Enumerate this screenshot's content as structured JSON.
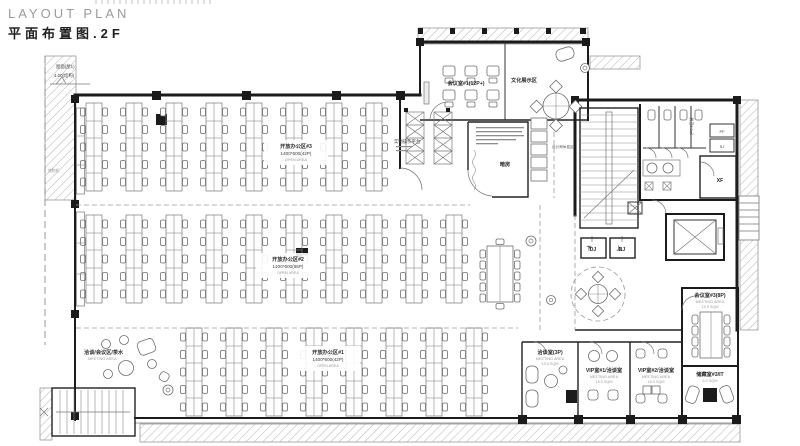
{
  "title": {
    "en": "LAYOUT PLAN",
    "cn": "平面布置图.2F"
  },
  "annotations": {
    "roof_line1": "屋面(屋1)",
    "roof_line2": "4.00(结构)",
    "cabinet": "储物柜",
    "rest_area": "设计师休息区"
  },
  "open_areas": {
    "a3": {
      "name": "开放办公区#3",
      "spec": "1400*600(42P)",
      "sub": "OPEN AREA"
    },
    "a2": {
      "name": "开放办公区#2",
      "spec": "1400*600(66P)",
      "sub": "OPEN AREA"
    },
    "a1": {
      "name": "开放办公区#1",
      "spec": "1400*600(42P)",
      "sub": "OPEN AREA"
    }
  },
  "rooms": {
    "meeting1": {
      "name": "会议室#1(12P+)"
    },
    "culture": {
      "name": "文化展示区"
    },
    "workbench": {
      "name": "实物操作平台"
    },
    "darkroom": {
      "name": "暗房"
    },
    "tea": {
      "name": "洽谈/会议区/茶水",
      "sub": "MEETING AREA"
    },
    "meet3": {
      "name": "会议室#3(8P)",
      "sub": "MEETING AREA",
      "area": "15.5 SQM"
    },
    "storage": {
      "name": "储藏室#3/IT",
      "area": "6.0 SQM"
    },
    "talk": {
      "name": "洽谈室(3P)",
      "sub": "MEETING AREA",
      "area": "15.0 SQM"
    },
    "vip1": {
      "name": "VIP室#1/洽谈室",
      "sub": "MEETING AREA",
      "area": "15.0 SQM"
    },
    "vip2": {
      "name": "VIP室#2/洽谈室",
      "sub": "MEETING AREA",
      "area": "15.0 SQM"
    }
  },
  "core": {
    "wc": "男卫6.0㎡",
    "pf": "PF",
    "sj": "SJ",
    "xf": "XF",
    "dj": "DJ",
    "nj": "NJ",
    "up": "上",
    "down": "下"
  },
  "colors": {
    "wall": "#1b1b1b",
    "furniture_line": "#6e6e6e",
    "hatch": "#b5b5b5",
    "label": "#2c2c2c",
    "sub_label": "#9b9b9b",
    "title_gray": "#9b9b9b"
  }
}
